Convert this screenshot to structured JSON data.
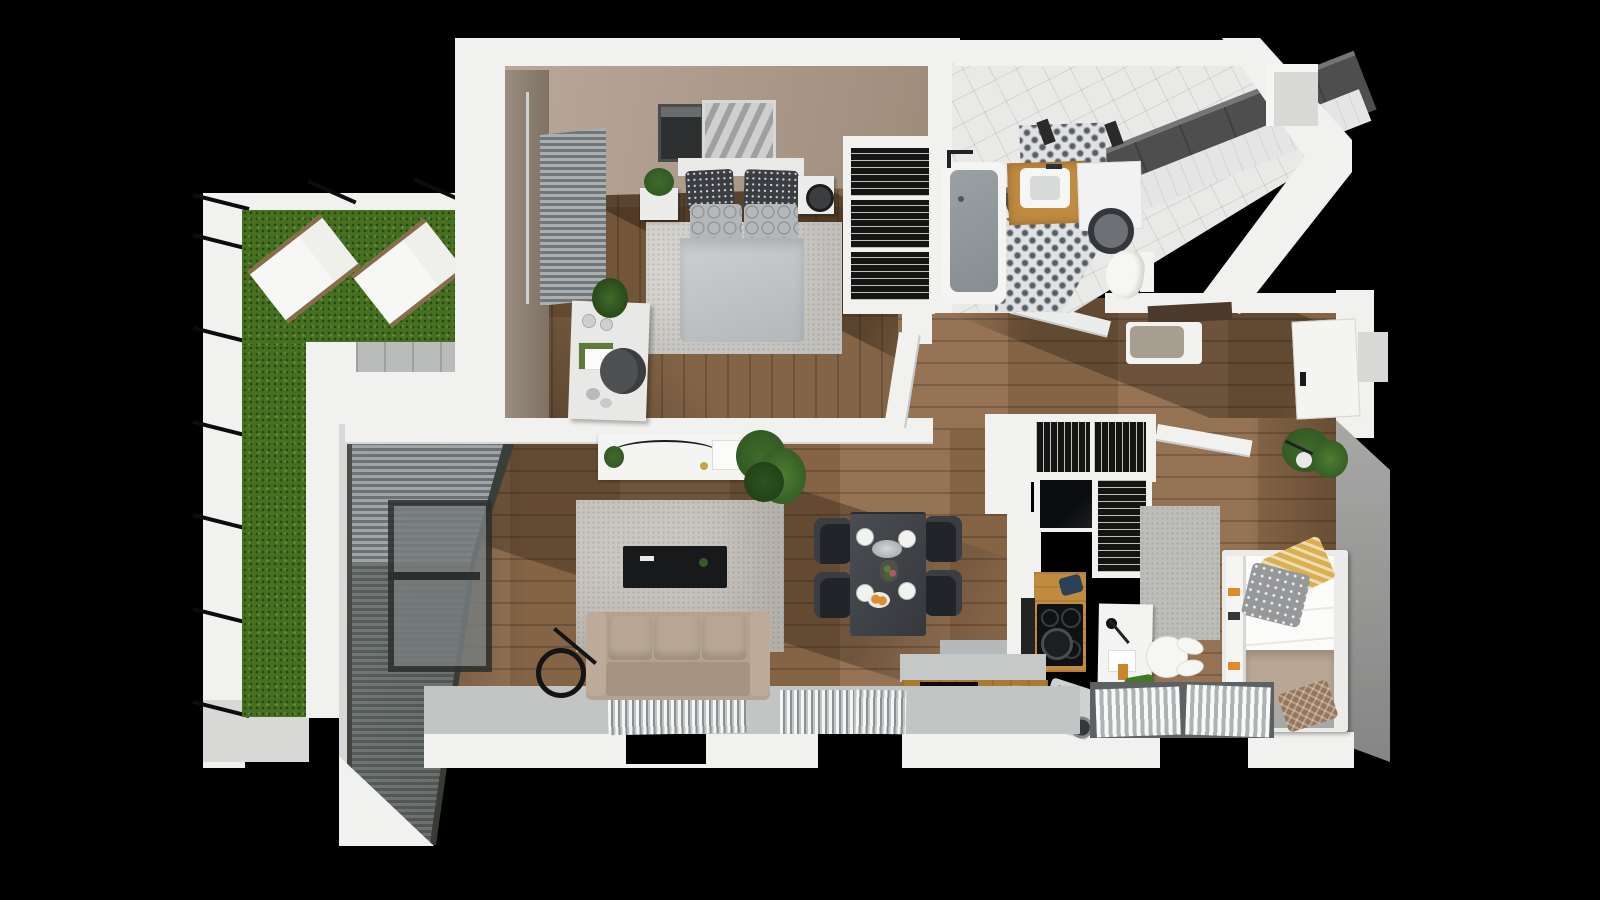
{
  "scene": {
    "type": "3d-floor-plan-render",
    "view": "top-down",
    "description": "Photorealistic top-down 3D render of a furnished apartment floor plan on a black background, with a grass terrace on the left"
  },
  "palette": {
    "bg": "#000000",
    "wall": "#f1f1f0",
    "wallShade": "#d8d8d6",
    "beige1": "#b9a89a",
    "beige2": "#9c8b79",
    "taupe1": "#9a8d80",
    "taupe2": "#7f7264",
    "grayWall1": "#a8a8a7",
    "grayWall2": "#858584",
    "wood": "#7c5c3d",
    "woodLight": "#8f6c4b",
    "oak": "#c08a3f",
    "oakDark": "#a87a32",
    "grass": "#45701f",
    "paver": "#b9bcba",
    "glass1": "#4a4f48",
    "glass2": "#2e322c",
    "sill": "#c3c5c4",
    "sillDark": "#5d6164",
    "rug": "#cac7c0",
    "rugBed": "#d6d4cf",
    "rugKid": "#bdbeba",
    "sofa": "#b3a28f",
    "sofaDark": "#a5947f",
    "table": "#42464a",
    "chair": "#212428",
    "cooktop": "#101113",
    "tileWhite": "#e9eae8",
    "tileDark": "#474747",
    "tubInner": "#9aa0a4",
    "duvet": "#c9cdcf",
    "benchCushion": "#a79d90",
    "shelfBrown": "#4c3b2c",
    "plant": "#3f6b2a",
    "plantDark": "#2d5320",
    "orange": "#e08b2d",
    "gold": "#c9a24a",
    "yellowPillow": "#d9af52",
    "grayPillow": "#97989a",
    "blanket": "#b8a795",
    "brownPillow": "#96765a",
    "blackGlass": "#0b0c0d"
  },
  "rooms": [
    {
      "name": "terrace",
      "items": [
        "grass lawn",
        "sun lounger",
        "sun lounger",
        "stone pavers",
        "railing ties"
      ]
    },
    {
      "name": "master-bedroom",
      "items": [
        "double bed",
        "nightstand left",
        "nightstand right",
        "wall art",
        "wardrobe with hangers",
        "desk",
        "desk chair",
        "rug",
        "window blinds",
        "potted plant"
      ]
    },
    {
      "name": "bathroom",
      "items": [
        "bathtub",
        "vanity sink",
        "washing machine",
        "toilet",
        "patterned tile floor",
        "dark tile wall"
      ]
    },
    {
      "name": "hallway",
      "items": [
        "bench with cushion",
        "wall shelf",
        "entrance door",
        "coat closet with hangers"
      ]
    },
    {
      "name": "living-room",
      "items": [
        "sofa",
        "rug",
        "tv console",
        "floor lamp",
        "console table",
        "large plant",
        "glazed wall with blinds",
        "radiator grilles"
      ]
    },
    {
      "name": "dining-area",
      "items": [
        "dining table",
        "chair",
        "chair",
        "chair",
        "chair",
        "plates",
        "serving tray",
        "flower vase",
        "oranges"
      ]
    },
    {
      "name": "kitchen",
      "items": [
        "l-shaped counter",
        "induction cooktop",
        "pot",
        "kettle",
        "coffee machine",
        "cutting board",
        "black glass cabinet",
        "pantry column with hangers"
      ]
    },
    {
      "name": "kids-bedroom",
      "items": [
        "single bed",
        "bookshelf headboard",
        "pillow yellow",
        "pillow gray",
        "blanket",
        "pillow brown",
        "desk",
        "bunny chair",
        "rug",
        "potted plant",
        "lizard toy",
        "window blinds"
      ]
    }
  ]
}
